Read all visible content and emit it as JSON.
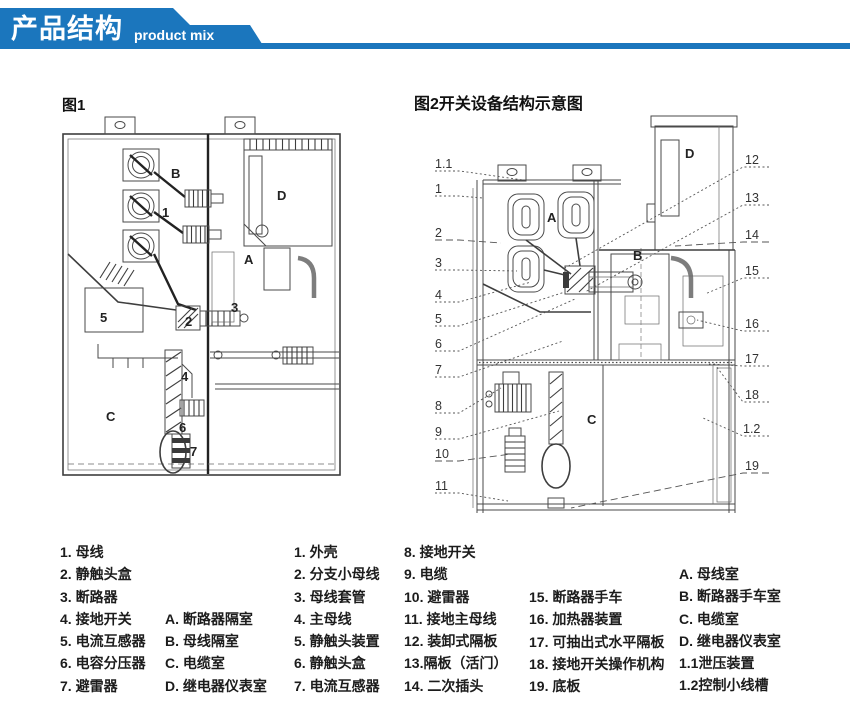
{
  "header": {
    "title": "产品结构",
    "subtitle": "product mix",
    "accent_color": "#1b76bd"
  },
  "fig1": {
    "title": "图1",
    "labels": [
      "B",
      "1",
      "D",
      "A",
      "3",
      "2",
      "5",
      "4",
      "C",
      "6",
      "7"
    ]
  },
  "fig2": {
    "title": "图2开关设备结构示意图",
    "callouts_left": [
      "1.1",
      "1",
      "2",
      "3",
      "4",
      "5",
      "6",
      "7",
      "8",
      "9",
      "10",
      "11"
    ],
    "callouts_right": [
      "12",
      "13",
      "14",
      "15",
      "16",
      "17",
      "18",
      "1.2",
      "19"
    ],
    "inner_labels": [
      "A",
      "B",
      "C",
      "D"
    ]
  },
  "legend": {
    "fig1_items": [
      "1. 母线",
      "2. 静触头盒",
      "3. 断路器",
      "4. 接地开关",
      "5. 电流互感器",
      "6. 电容分压器",
      "7. 避雷器"
    ],
    "fig1_rooms": [
      "A. 断路器隔室",
      "B. 母线隔室",
      "C. 电缆室",
      "D. 继电器仪表室"
    ],
    "fig2_items_a": [
      "1. 外壳",
      "2. 分支小母线",
      "3. 母线套管",
      "4. 主母线",
      "5. 静触头装置",
      "6. 静触头盒",
      "7. 电流互感器"
    ],
    "fig2_items_b": [
      "8. 接地开关",
      "9. 电缆",
      "10. 避雷器",
      "11. 接地主母线",
      "12. 装卸式隔板",
      "13.隔板（活门）",
      "14. 二次插头"
    ],
    "fig2_items_c": [
      "15. 断路器手车",
      "16. 加热器装置",
      "17. 可抽出式水平隔板",
      "18. 接地开关操作机构",
      "19. 底板"
    ],
    "fig2_rooms": [
      "A. 母线室",
      "B. 断路器手车室",
      "C. 电缆室",
      "D. 继电器仪表室",
      "1.1泄压装置",
      "1.2控制小线槽"
    ]
  }
}
